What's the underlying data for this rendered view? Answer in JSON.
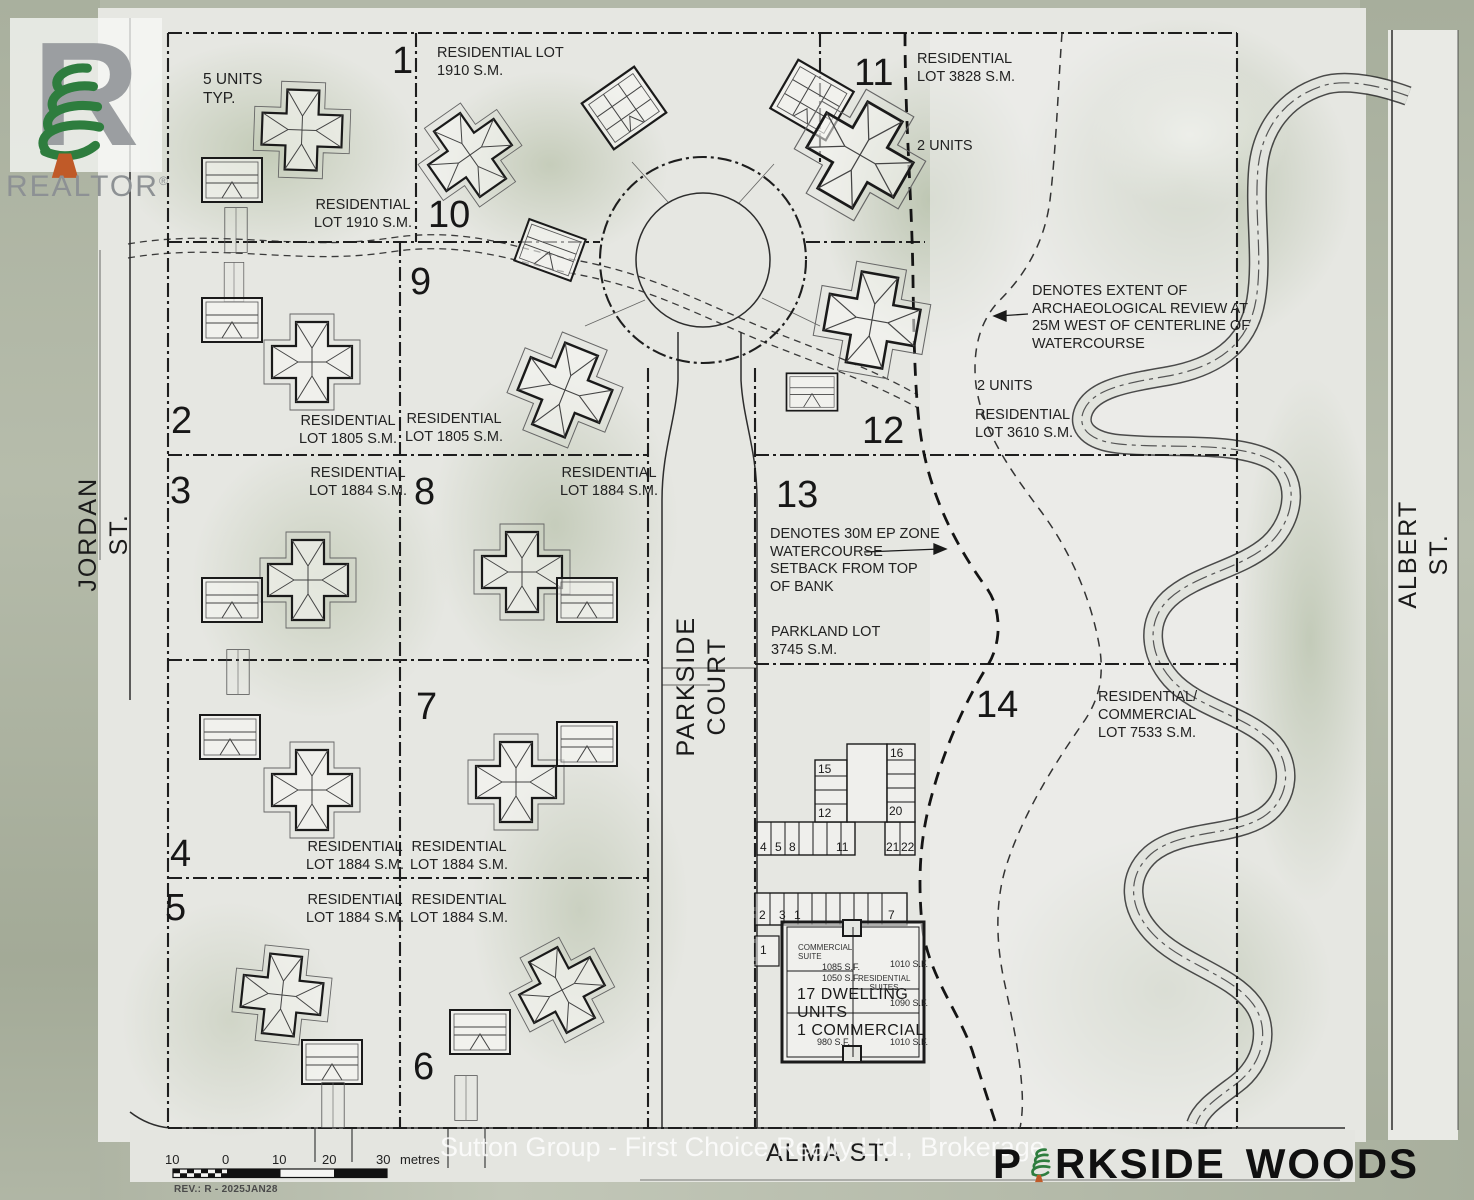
{
  "branding": {
    "realtor": "REALTOR",
    "registered": "®",
    "watermark": "Sutton Group - First Choice Realty Ltd., Brokerage",
    "title_p": "P",
    "title_rkside": "RKSIDE",
    "title_woods": "WOODS"
  },
  "streets": {
    "left": "JORDAN ST.",
    "right": "ALBERT ST.",
    "bottom": "ALMA ST.",
    "court": "PARKSIDE COURT"
  },
  "lots": {
    "n1": "1",
    "n2": "2",
    "n3": "3",
    "n4": "4",
    "n5": "5",
    "n6": "6",
    "n7": "7",
    "n8": "8",
    "n9": "9",
    "n10": "10",
    "n11": "11",
    "n12": "12",
    "n13": "13",
    "n14": "14",
    "l1": [
      "RESIDENTIAL LOT",
      "1910 S.M."
    ],
    "l2": [
      "RESIDENTIAL",
      "LOT 1805 S.M."
    ],
    "l3": [
      "RESIDENTIAL",
      "LOT 1884 S.M."
    ],
    "l4": [
      "RESIDENTIAL",
      "LOT 1884 S.M."
    ],
    "l5": [
      "RESIDENTIAL",
      "LOT 1884 S.M."
    ],
    "l6": [
      "RESIDENTIAL",
      "LOT 1884 S.M."
    ],
    "l7": [
      "RESIDENTIAL",
      "LOT 1884 S.M."
    ],
    "l8": [
      "RESIDENTIAL",
      "LOT 1884 S.M."
    ],
    "l9": [
      "RESIDENTIAL",
      "LOT 1805 S.M."
    ],
    "l10": [
      "RESIDENTIAL",
      "LOT 1910 S.M."
    ],
    "l11": [
      "RESIDENTIAL",
      "LOT 3828 S.M."
    ],
    "l12": [
      "RESIDENTIAL",
      "LOT 3610 S.M."
    ],
    "l14": [
      "RESIDENTIAL/",
      "COMMERCIAL",
      "LOT 7533 S.M."
    ],
    "units2_11": "2 UNITS",
    "units2_12": "2 UNITS"
  },
  "annotations": {
    "five_units": [
      "5 UNITS",
      "TYP."
    ],
    "arch": [
      "DENOTES EXTENT OF",
      "ARCHAEOLOGICAL REVIEW AT",
      "25M WEST OF CENTERLINE OF",
      "WATERCOURSE"
    ],
    "ep": [
      "DENOTES 30M EP ZONE",
      "WATERCOURSE",
      "SETBACK FROM TOP",
      "OF BANK"
    ],
    "parkland": [
      "PARKLAND LOT",
      "3745 S.M."
    ],
    "dwelling": [
      "17 DWELLING",
      "UNITS",
      "1 COMMERCIAL"
    ]
  },
  "building": {
    "u15": "15",
    "u12": "12",
    "u16": "16",
    "u20": "20",
    "row_bottom": [
      "4",
      "5",
      "8",
      "11",
      "21",
      "22"
    ],
    "row_mid": [
      "2",
      "3",
      "1",
      "7"
    ],
    "single": "1",
    "commercial_suite": [
      "COMMERCIAL",
      "SUITE"
    ],
    "residential_suites": [
      "RESIDENTIAL",
      "SUITES"
    ],
    "a1085": "1085 S.F.",
    "a1010a": "1010 S.F.",
    "a1050": "1050 S.F.",
    "a1090": "1090 S.F.",
    "a980": "980 S.F.",
    "a1010b": "1010 S.F."
  },
  "scalebar": {
    "t10a": "10",
    "t0": "0",
    "t10b": "10",
    "t20": "20",
    "t30": "30",
    "unit": "metres"
  },
  "revision": "REV.: R - 2025JAN28",
  "colors": {
    "pine": "#2e7d3e",
    "trunk": "#c05a28",
    "ink": "#1c1c1c",
    "paper": "#e6e7e2"
  }
}
